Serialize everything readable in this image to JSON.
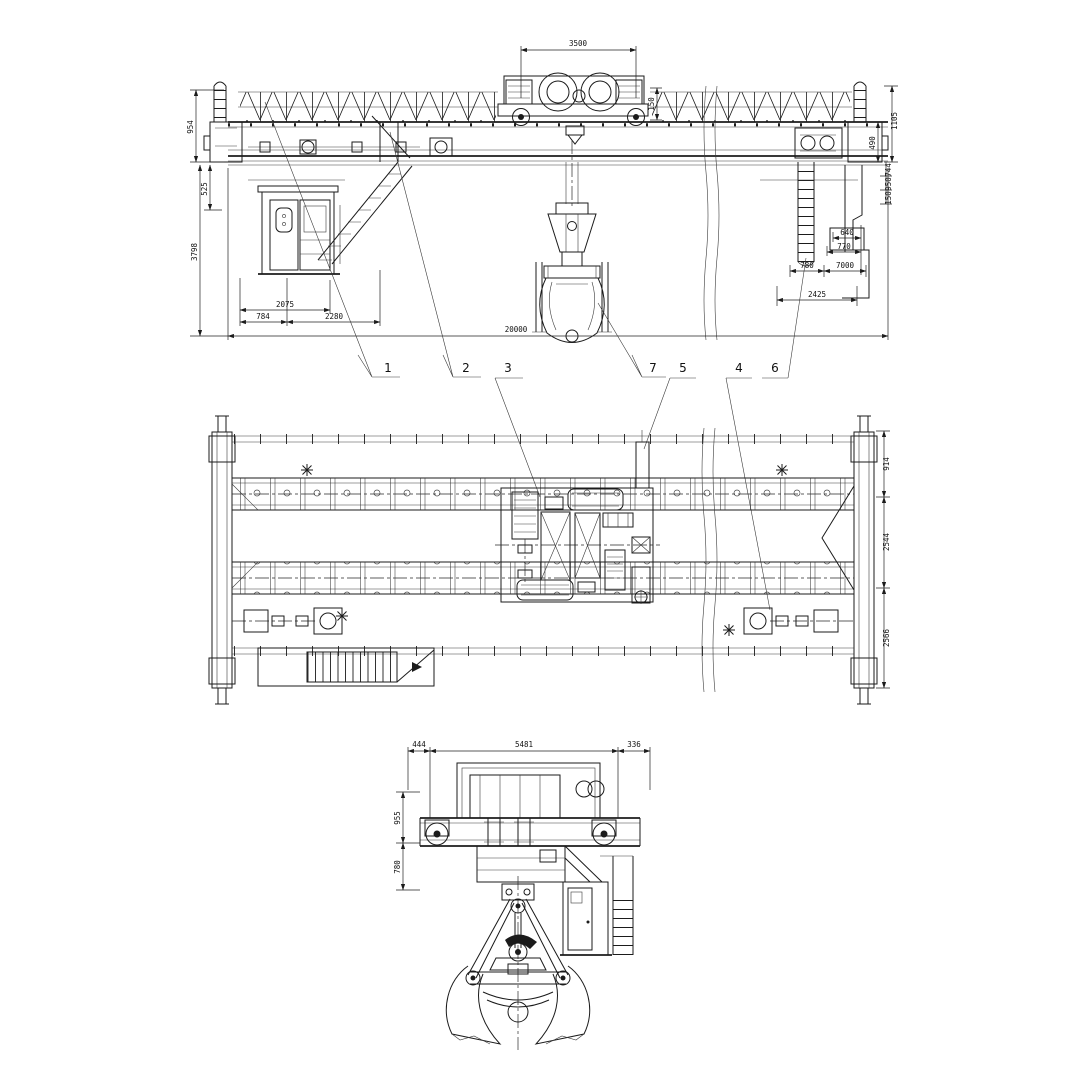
{
  "drawing": {
    "type": "engineering-drawing",
    "subject": "double-girder overhead grab crane, three orthographic views",
    "line_color": "#1b1b1b",
    "background": "#ffffff"
  },
  "front": {
    "dims": {
      "trolley_gauge": "3500",
      "trolley_side": "150",
      "left_top": "954",
      "left_mid": "525",
      "left_height": "3798",
      "span": "20000",
      "cab_a": "2075",
      "cab_b": "784",
      "cab_c": "2280",
      "right_v1": "1105",
      "right_v2": "490",
      "right_v3": "744",
      "right_v4": "950",
      "right_v5": "150",
      "right_h1": "640",
      "right_h2": "770",
      "right_h3": "780",
      "right_h4": "7000",
      "right_h5": "2425"
    }
  },
  "plan": {
    "dims": {
      "right_top": "914",
      "right_mid": "2544",
      "right_bottom": "2566"
    }
  },
  "side": {
    "dims": {
      "top_left": "444",
      "top_center": "5481",
      "top_right": "336",
      "left_top": "955",
      "left_bottom": "780"
    }
  },
  "callouts": {
    "c1": "1",
    "c2": "2",
    "c3": "3",
    "c7": "7",
    "c5": "5",
    "c4": "4",
    "c6": "6"
  }
}
